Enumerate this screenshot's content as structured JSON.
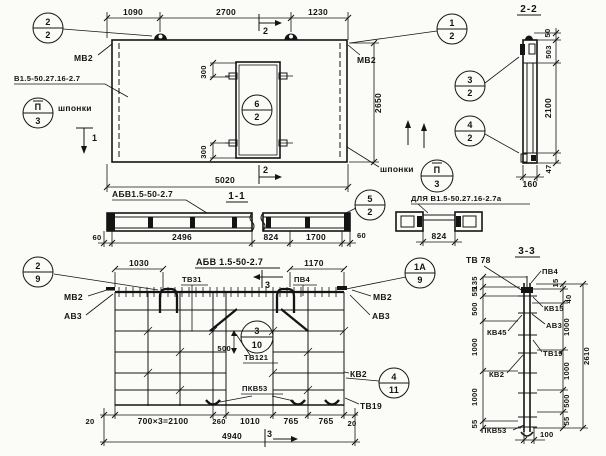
{
  "top_plan": {
    "dims": {
      "top1": "1090",
      "top2": "2700",
      "top3": "1230",
      "length": "5020",
      "height": "2650",
      "opening_top": "300",
      "opening_bottom": "300"
    },
    "labels": {
      "mv2_left": "МВ2",
      "mv2_right": "МВ2",
      "panel_mark": "В1.5-50.27.16-2.7",
      "keys_left": "шпонки",
      "keys_right": "шпонки"
    },
    "callouts": {
      "c2_2": {
        "a": "2",
        "b": "2"
      },
      "c1_2": {
        "a": "1",
        "b": "2"
      },
      "c6_2": {
        "a": "6",
        "b": "2"
      },
      "keys_left": {
        "a": "П",
        "b": "3"
      },
      "keys_right": {
        "a": "П",
        "b": "3"
      }
    },
    "sections": {
      "s1": "1",
      "s2_top": "2",
      "s2_bottom": "2"
    }
  },
  "section_2_2": {
    "title": "2-2",
    "dims": {
      "d50": "50",
      "d503": "503",
      "d2100": "2100",
      "d47": "47",
      "thickness": "160"
    },
    "callouts": {
      "c3_2": {
        "a": "3",
        "b": "2"
      },
      "c4_2": {
        "a": "4",
        "b": "2"
      }
    }
  },
  "section_1_1": {
    "title": "1-1",
    "label": "АБВ1.5-50-2.7",
    "callout_5_2": {
      "a": "5",
      "b": "2"
    },
    "dims": {
      "left60": "60",
      "d2496": "2496",
      "d824": "824",
      "d1700": "1700",
      "right60": "60"
    },
    "variant": {
      "label": "ДЛЯ В1.5-50.27.16-2.7а",
      "d824": "824"
    }
  },
  "bottom_plan": {
    "title": "АБВ 1.5-50-2.7",
    "labels": {
      "mv2_left": "МВ2",
      "av3_left": "АВ3",
      "tv31": "ТВ31",
      "pv4": "ПВ4",
      "mv2_right": "МВ2",
      "av3_right": "АВ3",
      "tv121": "ТВ121",
      "pkv53": "ПКВ53",
      "kv2": "КВ2",
      "tv19": "ТВ19"
    },
    "callouts": {
      "c2_9": {
        "a": "2",
        "b": "9"
      },
      "c1a_9": {
        "a": "1А",
        "b": "9"
      },
      "c3_10": {
        "a": "3",
        "b": "10"
      },
      "c4_11": {
        "a": "4",
        "b": "11"
      }
    },
    "dims": {
      "d1030": "1030",
      "d1170": "1170",
      "d500": "500",
      "row": [
        "20",
        "700×3=2100",
        "260",
        "1010",
        "765",
        "765",
        "20"
      ],
      "total": "4940"
    },
    "section3": "3"
  },
  "section_3_3": {
    "title": "3-3",
    "labels": {
      "tv78": "ТВ 78",
      "pv4": "ПВ4",
      "kv15": "КВ15",
      "av3": "АВ3",
      "tv19": "ТВ19",
      "kv45": "КВ45",
      "kv2": "КВ2",
      "pkv53": "ПКВ53"
    },
    "dims_left": [
      "135",
      "55",
      "500",
      "1000",
      "1000",
      "55"
    ],
    "dims_right": [
      "15",
      "40",
      "1000",
      "1000",
      "500",
      "55"
    ],
    "overall": "2610",
    "bottom": "100"
  }
}
